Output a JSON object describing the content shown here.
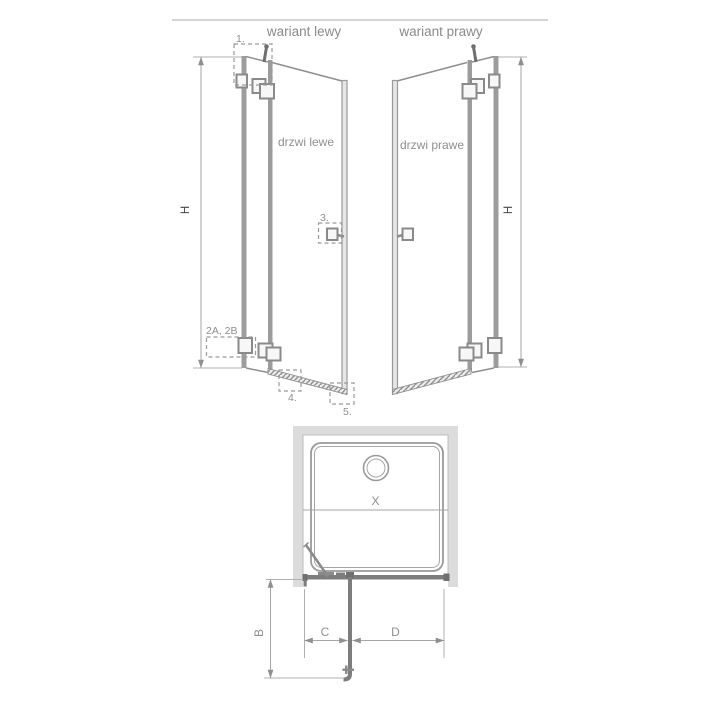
{
  "diagram": {
    "top_titles": {
      "left": "wariant lewy",
      "right": "wariant prawy"
    },
    "door_labels": {
      "left": "drzwi lewe",
      "right": "drzwi prawe"
    },
    "dimension_letters": {
      "height": "H",
      "width": "X",
      "b": "B",
      "c": "C",
      "d": "D"
    },
    "part_labels": {
      "p1": "1.",
      "p2": "2A, 2B",
      "p3": "3.",
      "p4": "4.",
      "p5": "5."
    },
    "colors": {
      "background": "#ffffff",
      "line_gray": "#8f8f8f",
      "profile_gray": "#9c9c9c",
      "wall_light_gray": "#dcdcdc",
      "hardware_dark_gray": "#707070",
      "text_gray": "#8a8a8a",
      "h_label_dark": "#474747"
    }
  }
}
